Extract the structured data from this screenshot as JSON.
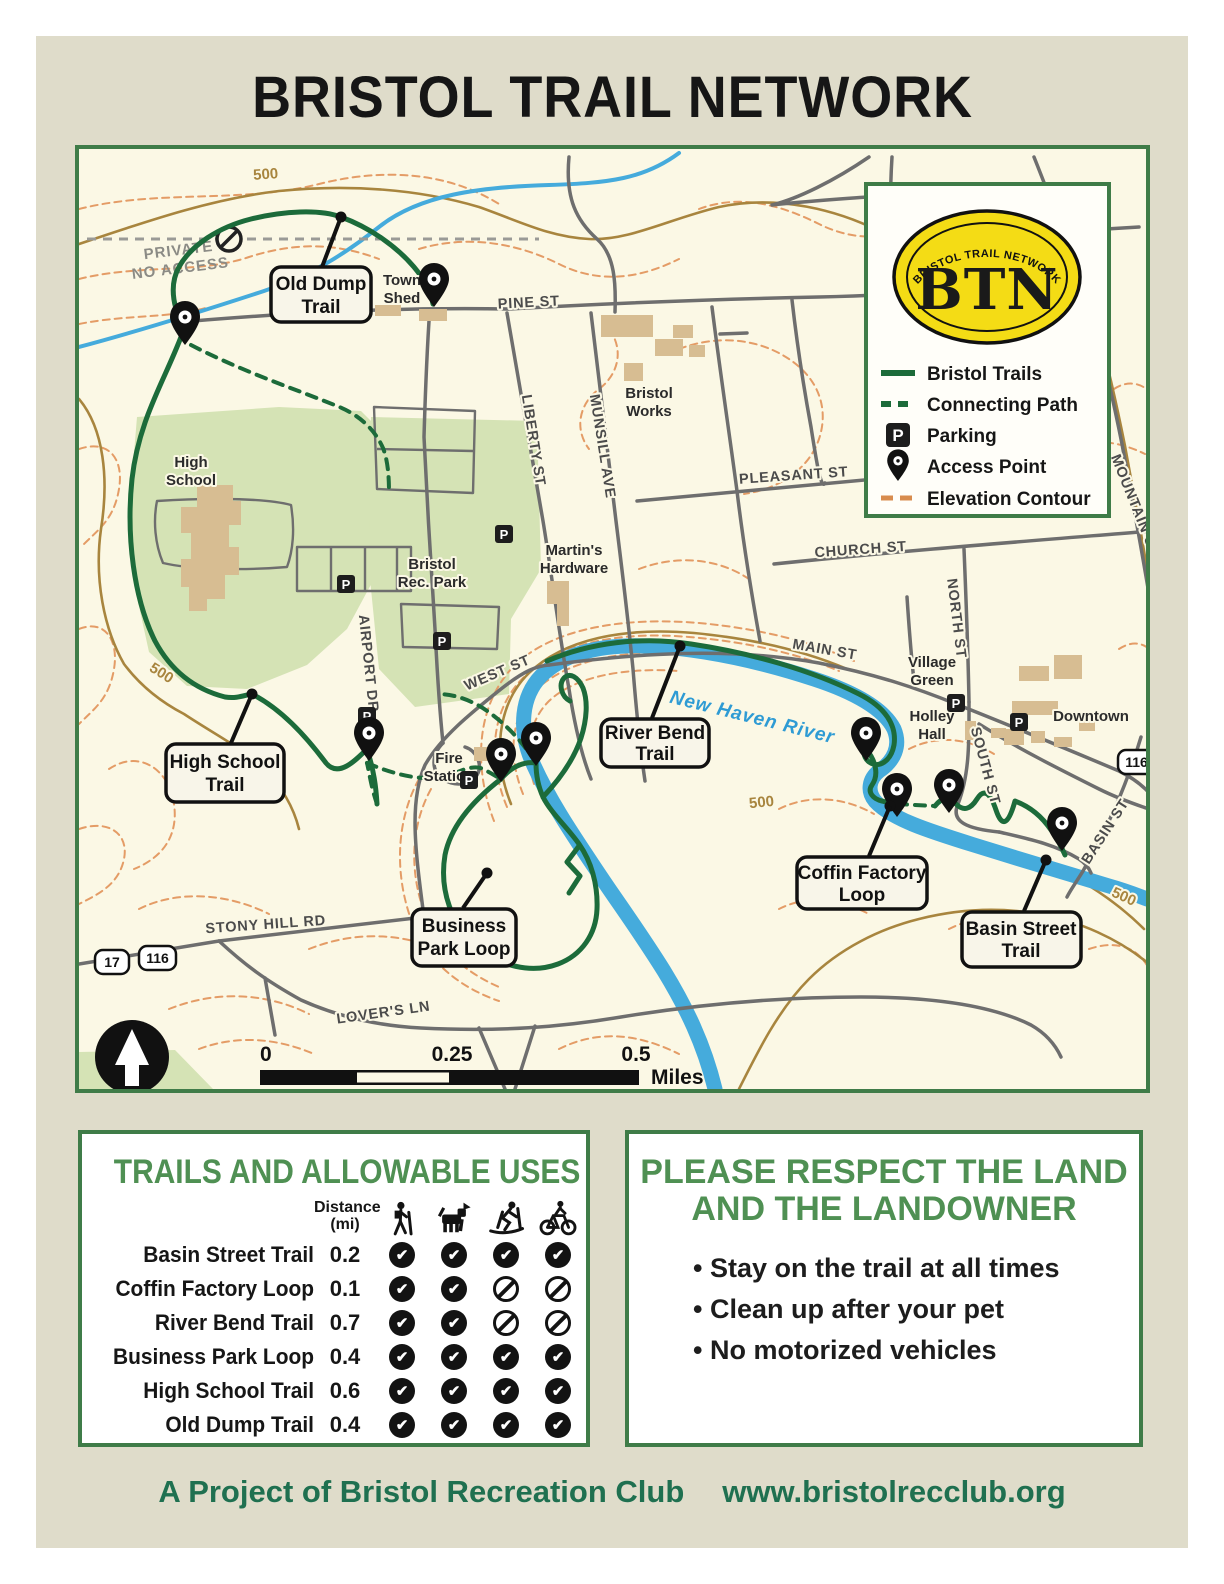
{
  "title": "BRISTOL TRAIL NETWORK",
  "map": {
    "legend": {
      "arc_text": "BRISTOL TRAIL NETWORK",
      "acronym": "BTN",
      "items": [
        {
          "label": "Bristol Trails"
        },
        {
          "label": "Connecting Path"
        },
        {
          "label": "Parking"
        },
        {
          "label": "Access Point"
        },
        {
          "label": "Elevation Contour"
        }
      ]
    },
    "streets": {
      "pine": "PINE ST",
      "liberty": "LIBERTY ST",
      "munsill": "MUNSILL AVE",
      "pleasant": "PLEASANT ST",
      "church": "CHURCH ST",
      "north": "NORTH ST",
      "main": "MAIN ST",
      "west": "WEST ST",
      "airport": "AIRPORT DR",
      "south": "SOUTH ST",
      "mountain": "MOUNTAIN ST",
      "basin": "BASIN ST",
      "stony_hill": "STONY HILL RD",
      "lovers": "LOVER'S LN"
    },
    "places": {
      "high_school": {
        "line1": "High",
        "line2": "School"
      },
      "bristol_rec_park": {
        "line1": "Bristol",
        "line2": "Rec. Park"
      },
      "bristol_works": {
        "line1": "Bristol",
        "line2": "Works"
      },
      "martins": {
        "line1": "Martin's",
        "line2": "Hardware"
      },
      "town_shed": {
        "line1": "Town",
        "line2": "Shed"
      },
      "fire_station": {
        "line1": "Fire",
        "line2": "Station"
      },
      "village_green": {
        "line1": "Village",
        "line2": "Green"
      },
      "holley_hall": {
        "line1": "Holley",
        "line2": "Hall"
      },
      "downtown": "Downtown"
    },
    "trail_labels": {
      "old_dump": {
        "line1": "Old Dump",
        "line2": "Trail"
      },
      "high_school": {
        "line1": "High School",
        "line2": "Trail"
      },
      "river_bend": {
        "line1": "River Bend",
        "line2": "Trail"
      },
      "business_park": {
        "line1": "Business",
        "line2": "Park Loop"
      },
      "coffin_factory": {
        "line1": "Coffin Factory",
        "line2": "Loop"
      },
      "basin_street": {
        "line1": "Basin Street",
        "line2": "Trail"
      }
    },
    "river_label": "New Haven River",
    "private_label": {
      "line1": "PRIVATE",
      "line2": "NO ACCESS"
    },
    "contour_label": "500",
    "routes": {
      "r17": "17",
      "r116": "116"
    },
    "parking_letter": "P",
    "scale": {
      "t0": "0",
      "t1": "0.25",
      "t2": "0.5",
      "unit": "Miles"
    }
  },
  "uses_table": {
    "heading": "TRAILS AND ALLOWABLE USES",
    "distance_header_line1": "Distance",
    "distance_header_line2": "(mi)",
    "activity_icons": [
      "hiking",
      "dog-walking",
      "cross-country-skiing",
      "biking"
    ],
    "rows": [
      {
        "name": "Basin Street Trail",
        "distance": "0.2",
        "marks": [
          "yes",
          "yes",
          "yes",
          "yes"
        ]
      },
      {
        "name": "Coffin Factory Loop",
        "distance": "0.1",
        "marks": [
          "yes",
          "yes",
          "no",
          "no"
        ]
      },
      {
        "name": "River Bend Trail",
        "distance": "0.7",
        "marks": [
          "yes",
          "yes",
          "no",
          "no"
        ]
      },
      {
        "name": "Business Park Loop",
        "distance": "0.4",
        "marks": [
          "yes",
          "yes",
          "yes",
          "yes"
        ]
      },
      {
        "name": "High School Trail",
        "distance": "0.6",
        "marks": [
          "yes",
          "yes",
          "yes",
          "yes"
        ]
      },
      {
        "name": "Old Dump Trail",
        "distance": "0.4",
        "marks": [
          "yes",
          "yes",
          "yes",
          "yes"
        ]
      }
    ]
  },
  "respect_box": {
    "heading_line1": "PLEASE RESPECT THE LAND",
    "heading_line2": "AND THE LANDOWNER",
    "bullets": [
      "Stay on the trail at all times",
      "Clean up after your pet",
      "No motorized vehicles"
    ]
  },
  "footer": {
    "credit": "A Project of Bristol Recreation Club",
    "website": "www.bristolrecclub.org"
  },
  "colors": {
    "poster_bg": "#DFDCCA",
    "map_bg": "#FBF8E5",
    "border_green": "#3F7C48",
    "heading_green": "#4F9053",
    "trail_green": "#1C6B3A",
    "river_blue": "#45ABDC",
    "contour_orange": "#E49C66",
    "index_contour_brown": "#A8853E",
    "road_gray": "#6E6E6E",
    "building_tan": "#D7BD92",
    "park_green": "#D5E3B5",
    "logo_yellow": "#F4DC15",
    "footer_green": "#1F7050"
  }
}
